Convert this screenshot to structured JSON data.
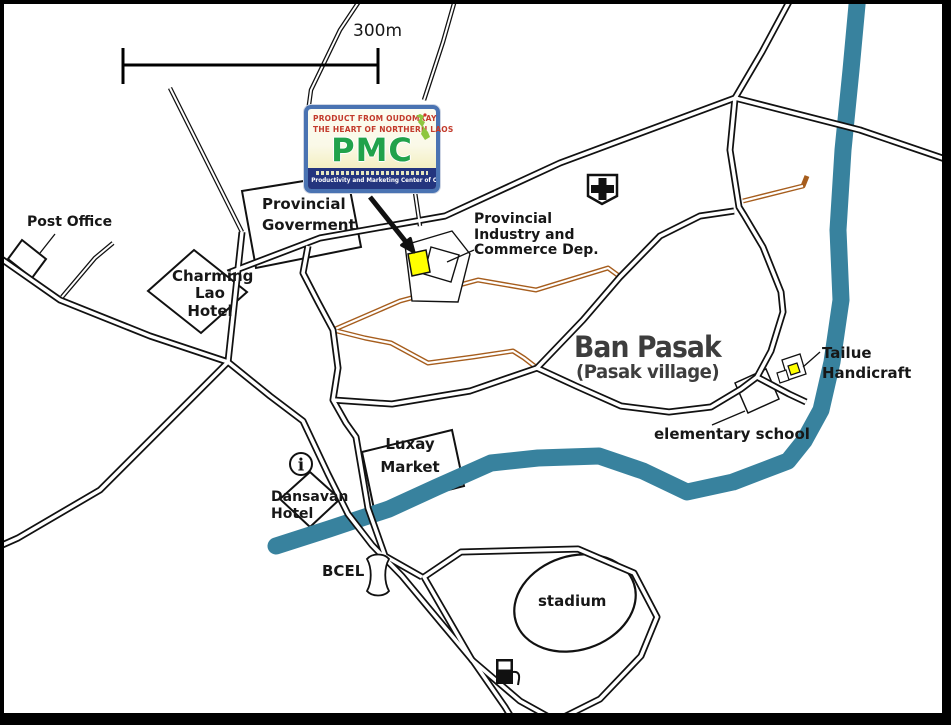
{
  "map": {
    "scale_label": "300m",
    "labels": {
      "post_office": "Post Office",
      "provincial_government_line1": "Provincial",
      "provincial_government_line2": "Goverment",
      "charming_line1": "Charming",
      "charming_line2": "Lao Hotel",
      "industry_line1": "Provincial",
      "industry_line2": "Industry  and",
      "industry_line3": "Commerce Dep.",
      "ban_pasak": "Ban Pasak",
      "ban_pasak_sub": "(Pasak village)",
      "tailue_line1": "Tailue",
      "tailue_line2": "Handicraft",
      "elementary_school": "elementary school",
      "luxay_line1": "Luxay",
      "luxay_line2": "Market",
      "dansavan_line1": "Dansavan",
      "dansavan_line2": "Hotel",
      "bcel": "BCEL",
      "stadium": "stadium"
    },
    "logo": {
      "line1": "PRODUCT FROM OUDOMXAY",
      "line2": "THE HEART OF NORTHERN LAOS",
      "acronym": "PMC",
      "footer": "Productivity and Marketing Center of Oudomxay"
    },
    "info_icon_glyph": "i",
    "colors": {
      "river": "#38829E",
      "dirt_road": "#A65D1D",
      "road_black": "#111111",
      "highlight_yellow": "#FFFF00",
      "logo_border": "#4A73B2",
      "logo_band": "#24357E",
      "logo_red": "#C23A2B",
      "logo_green": "#21A24B",
      "laos_map_green": "#8DC63F"
    }
  }
}
